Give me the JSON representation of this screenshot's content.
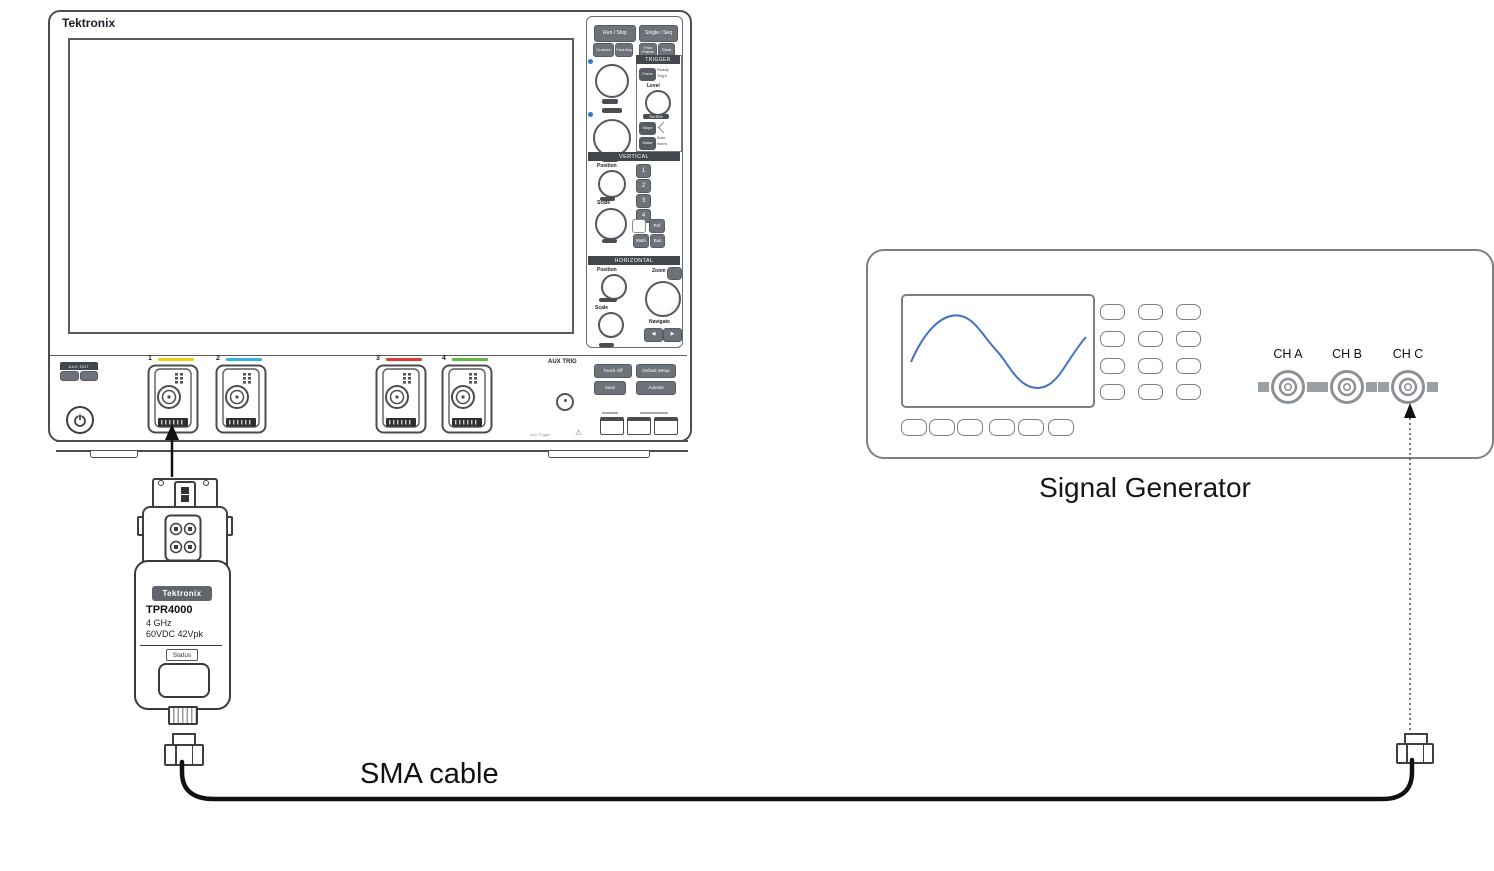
{
  "oscilloscope": {
    "brand": "Tektronix",
    "acquire": {
      "run_stop": "Run / Stop",
      "single_seq": "Single / Seq",
      "cursors": "Cursors",
      "fast_acq": "Fast Acq",
      "fast_frame": "Fast Frame",
      "clear": "Clear"
    },
    "trigger": {
      "header": "TRIGGER",
      "force": "Force",
      "ready": "Ready",
      "trigd": "Trig'd",
      "level": "Level",
      "set50": "Set 50%",
      "slope": "Slope",
      "mode": "Mode",
      "auto": "Auto",
      "norm": "Norm"
    },
    "vertical": {
      "header": "VERTICAL",
      "position": "Position",
      "scale": "Scale",
      "ch1": "1",
      "ch2": "2",
      "ch3": "3",
      "ch4": "4",
      "ref": "Ref",
      "math": "Math",
      "bus": "Bus"
    },
    "horizontal": {
      "header": "HORIZONTAL",
      "position": "Position",
      "scale": "Scale",
      "zoom": "Zoom",
      "navigate": "Navigate",
      "nav_left": "◀",
      "nav_right": "▶"
    },
    "front": {
      "io_badge": "AUX OUT",
      "aux_trig": "AUX TRIG",
      "touch_off": "Touch Off",
      "default_setup": "Default Setup",
      "save": "Save",
      "autoset": "Autoset",
      "aux_note": "Aux Trigger",
      "warning": "⚠"
    },
    "channels": [
      {
        "number": "1",
        "color": "#F2D00E"
      },
      {
        "number": "2",
        "color": "#35B5D9"
      },
      {
        "number": "3",
        "color": "#E03A36"
      },
      {
        "number": "4",
        "color": "#63B946"
      }
    ]
  },
  "probe": {
    "brand": "Tektronix",
    "model": "TPR4000",
    "bandwidth": "4 GHz",
    "rating": "60VDC 42Vpk",
    "status": "Status"
  },
  "signal_generator": {
    "caption": "Signal Generator",
    "channels": [
      "CH A",
      "CH B",
      "CH C"
    ]
  },
  "cable": {
    "label": "SMA cable"
  },
  "colors": {
    "accent_blue": "#2F7BC4",
    "sine_blue": "#4472C4",
    "device_outline_dark": "#4B4D50",
    "device_outline_gray": "#7F7F7F",
    "panel_dark": "#42474D",
    "button_gray": "#6E737A"
  }
}
